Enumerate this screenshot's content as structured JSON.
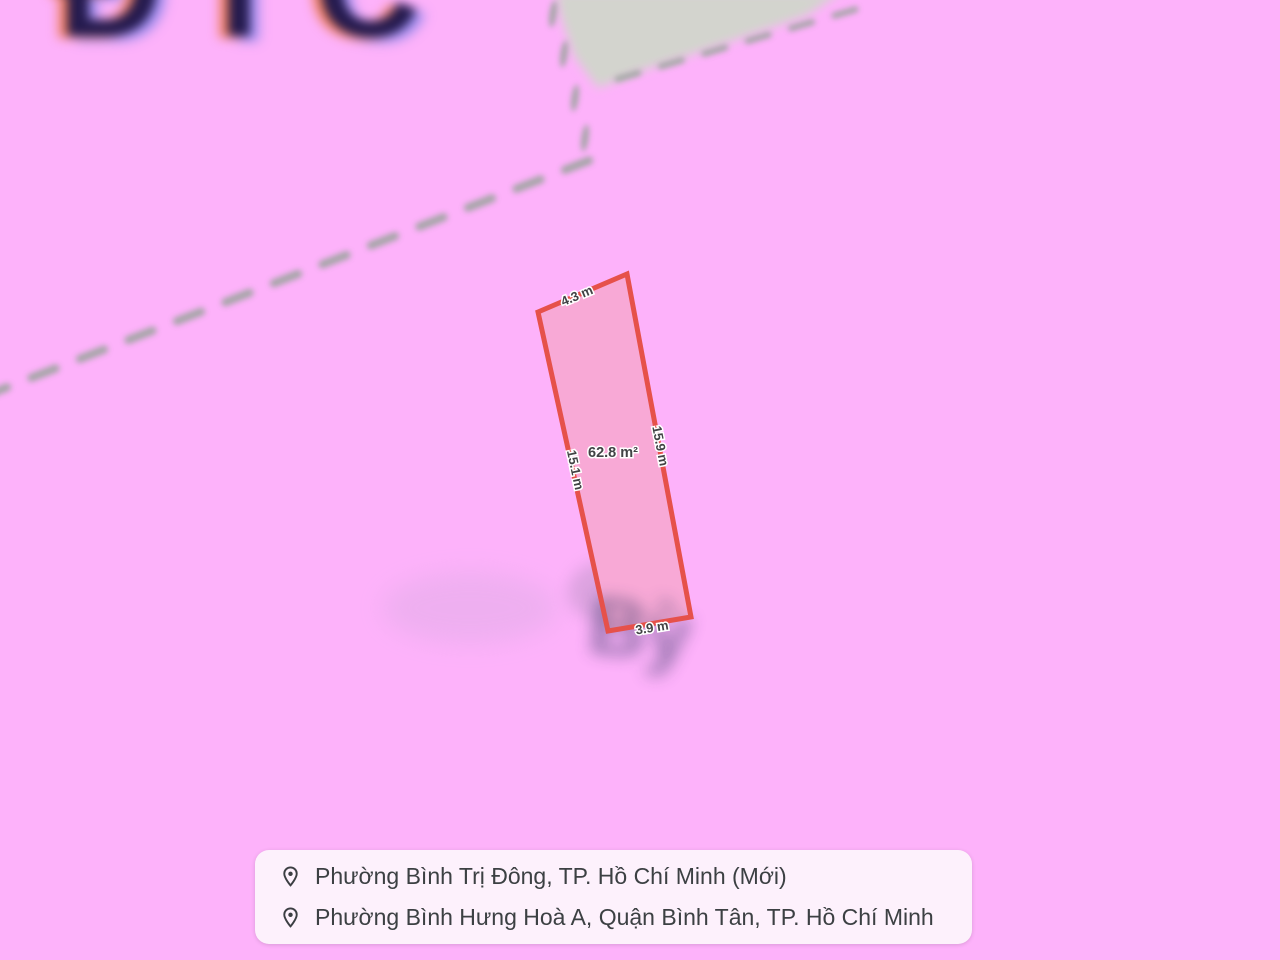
{
  "map": {
    "background_color": "#fdb2fa",
    "road_zone_color": "#d3d4ce",
    "boundary_dash_color": "#8fa392",
    "giant_blurred_label": "ĐTC",
    "blurred_parcel_label": "Bỳ",
    "parcel": {
      "area_label": "62.8 m²",
      "top_edge_label": "4.3 m",
      "right_edge_label": "15.9 m",
      "left_edge_label": "15.1 m",
      "bottom_edge_label": "3.9 m",
      "fill_color": "#f8a9d6",
      "stroke_color": "#e6514a"
    }
  },
  "info_card": {
    "background_color": "#fdf1fc",
    "text_color": "#3c4043",
    "rows": [
      {
        "icon": "location-pin",
        "text": "Phường Bình Trị Đông, TP. Hồ Chí Minh (Mới)"
      },
      {
        "icon": "location-pin",
        "text": "Phường Bình Hưng Hoà A, Quận Bình Tân, TP. Hồ Chí Minh"
      }
    ]
  }
}
